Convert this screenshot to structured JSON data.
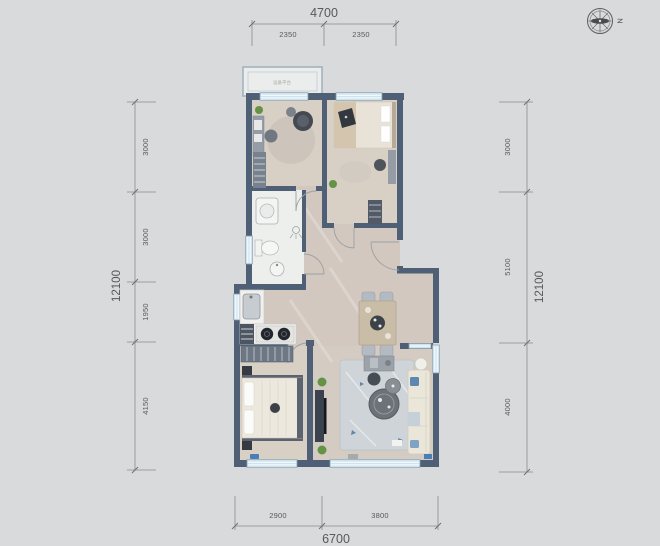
{
  "compass": {
    "label": "N"
  },
  "dimensions": {
    "top": {
      "total": "4700",
      "segments": [
        "2350",
        "2350"
      ]
    },
    "bottom": {
      "total": "6700",
      "segments": [
        "2900",
        "3800"
      ]
    },
    "left": {
      "total": "12100",
      "segments": [
        "3000",
        "3000",
        "1950",
        "4150"
      ]
    },
    "right": {
      "total": "12100",
      "segments": [
        "3000",
        "5100",
        "4000"
      ]
    }
  },
  "balcony": {
    "label": "设备平台"
  },
  "colors": {
    "background": "#d9dadb",
    "wall": "#4e5f76",
    "window": "#cfe3ee",
    "floor_wood": "#d8cfc5",
    "floor_marble": "#d2c8c0",
    "floor_bath": "#edefec",
    "living_rug": "#ced4d7",
    "accent_blue": "#5b87b0",
    "plant_green": "#649348",
    "dimension_text": "#595959"
  }
}
